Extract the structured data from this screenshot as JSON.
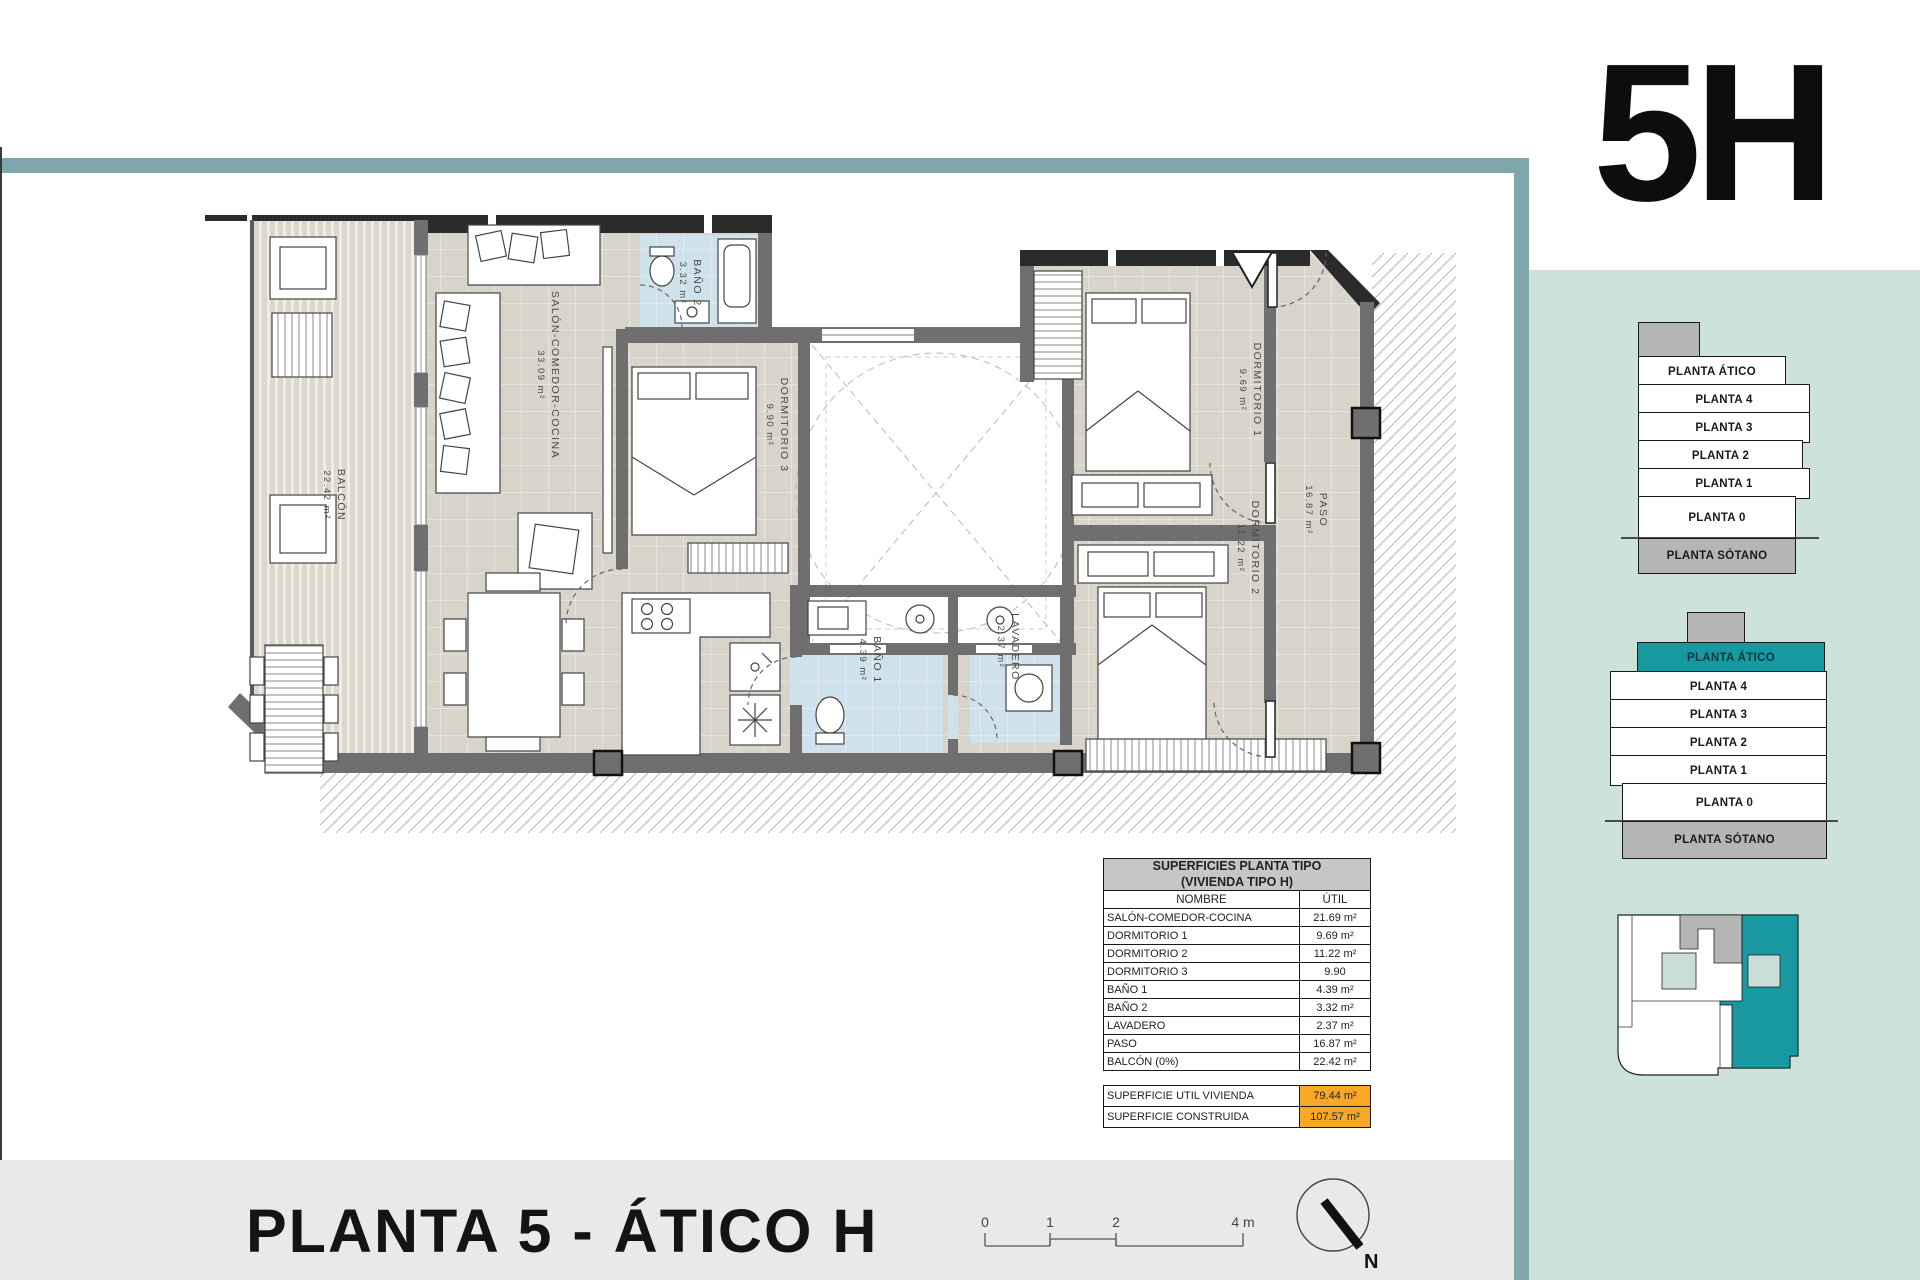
{
  "unit": {
    "label": "5H"
  },
  "title": "PLANTA 5 - ÁTICO H",
  "plan": {
    "rooms": [
      {
        "name": "BALCÓN",
        "area": "22.42 m²"
      },
      {
        "name": "SALÓN-COMEDOR-COCINA",
        "area": "33.09 m²"
      },
      {
        "name": "BAÑO 2",
        "area": "3.32 m²"
      },
      {
        "name": "DORMITORIO 3",
        "area": "9.90 m²"
      },
      {
        "name": "DORMITORIO 1",
        "area": "9.69 m²"
      },
      {
        "name": "DORMITORIO 2",
        "area": "11.22 m²"
      },
      {
        "name": "PASO",
        "area": "16.87 m²"
      },
      {
        "name": "BAÑO 1",
        "area": "4.39 m²"
      },
      {
        "name": "LAVADERO",
        "area": "2.37 m²"
      }
    ]
  },
  "surfaces_table": {
    "title_line1": "SUPERFICIES PLANTA TIPO",
    "title_line2": "(VIVIENDA TIPO H)",
    "col_name": "NOMBRE",
    "col_util": "ÚTIL",
    "rows": [
      {
        "name": "SALÓN-COMEDOR-COCINA",
        "util": "21.69 m²"
      },
      {
        "name": "DORMITORIO 1",
        "util": "9.69 m²"
      },
      {
        "name": "DORMITORIO 2",
        "util": "11.22 m²"
      },
      {
        "name": "DORMITORIO 3",
        "util": "9.90"
      },
      {
        "name": "BAÑO 1",
        "util": "4.39 m²"
      },
      {
        "name": "BAÑO 2",
        "util": "3.32 m²"
      },
      {
        "name": "LAVADERO",
        "util": "2.37 m²"
      },
      {
        "name": "PASO",
        "util": "16.87 m²"
      },
      {
        "name": "BALCÓN (0%)",
        "util": "22.42 m²"
      }
    ],
    "totals": [
      {
        "name": "SUPERFICIE UTIL VIVIENDA",
        "value": "79.44 m²"
      },
      {
        "name": "SUPERFICIE CONSTRUIDA",
        "value": "107.57 m²"
      }
    ]
  },
  "sidebar": {
    "stack_top": {
      "floors": [
        "PLANTA ÁTICO",
        "PLANTA 4",
        "PLANTA 3",
        "PLANTA 2",
        "PLANTA 1",
        "PLANTA 0",
        "PLANTA SÓTANO"
      ]
    },
    "stack_bottom": {
      "highlighted": "PLANTA ÁTICO",
      "floors": [
        "PLANTA ÁTICO",
        "PLANTA 4",
        "PLANTA 3",
        "PLANTA 2",
        "PLANTA 1",
        "PLANTA 0",
        "PLANTA SÓTANO"
      ]
    }
  },
  "footer": {
    "scale_ticks": [
      "0",
      "1",
      "2",
      "4 m"
    ],
    "north_label": "N"
  },
  "colors": {
    "teal_band": "#7FA6AD",
    "accent_teal": "#1899A2",
    "sidebar_green": "#CDE3DA",
    "table_header_gray": "#C6C6C6",
    "highlight_orange": "#F9A825",
    "wall_gray": "#6F6F6F",
    "floor_beige": "#D8D4C9",
    "bath_blue": "#CFE1EA",
    "footer_gray": "#E9E9E9",
    "stack_gray": "#B5B5B5"
  }
}
